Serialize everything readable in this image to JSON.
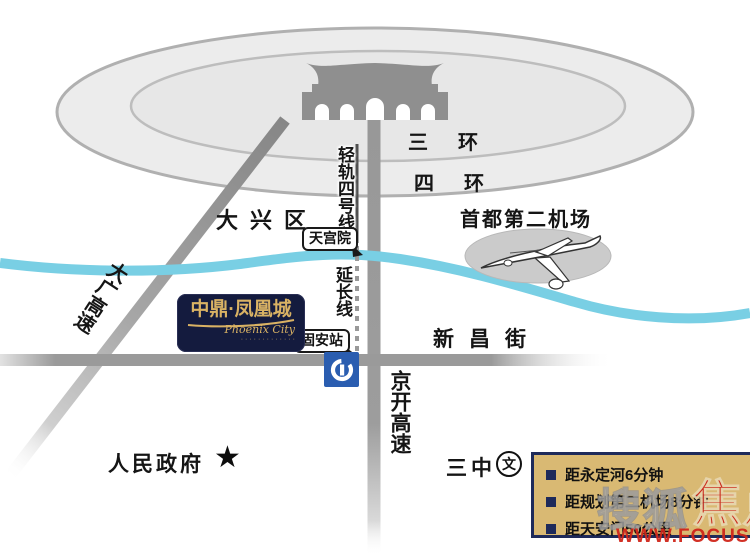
{
  "map": {
    "rings": {
      "ring3": "三环",
      "ring4": "四环"
    },
    "places": {
      "daxing_district": "大兴区",
      "airport": "首都第二机场",
      "government": "人民政府",
      "middle_school": "三中",
      "school_symbol": "文"
    },
    "roads": {
      "xinchang_street": "新昌街",
      "jingkai_expressway": "京开高速",
      "daguang_expressway": "大广高速"
    },
    "rail": {
      "line4": "轻轨四号线",
      "extension": "延长线",
      "station_tiangongyuan": "天宫院",
      "station_guan": "固安站"
    },
    "logo": {
      "name_cn": "中鼎·凤凰城",
      "name_en": "Phoenix City",
      "tagline_dots": "·············"
    },
    "info_box": {
      "items": [
        "距永定河6分钟",
        "距规划第二机场8分钟",
        "距天安门50公里"
      ]
    },
    "watermark": {
      "ghost_text": "搜狐",
      "red_text": "焦点",
      "url": "WWW.FOCUS."
    },
    "colors": {
      "river": "#79cfe4",
      "road_gray": "#9a9a9a",
      "city_fill": "#ececec",
      "gate_gray": "#8f8f8f",
      "metro_blue": "#2a5db0",
      "logo_navy": "#141b3e",
      "logo_gold": "#d9b264",
      "infobox_gold": "#d9b973",
      "infobox_navy": "#1e2a5a",
      "watermark_red": "#cb2117"
    }
  }
}
